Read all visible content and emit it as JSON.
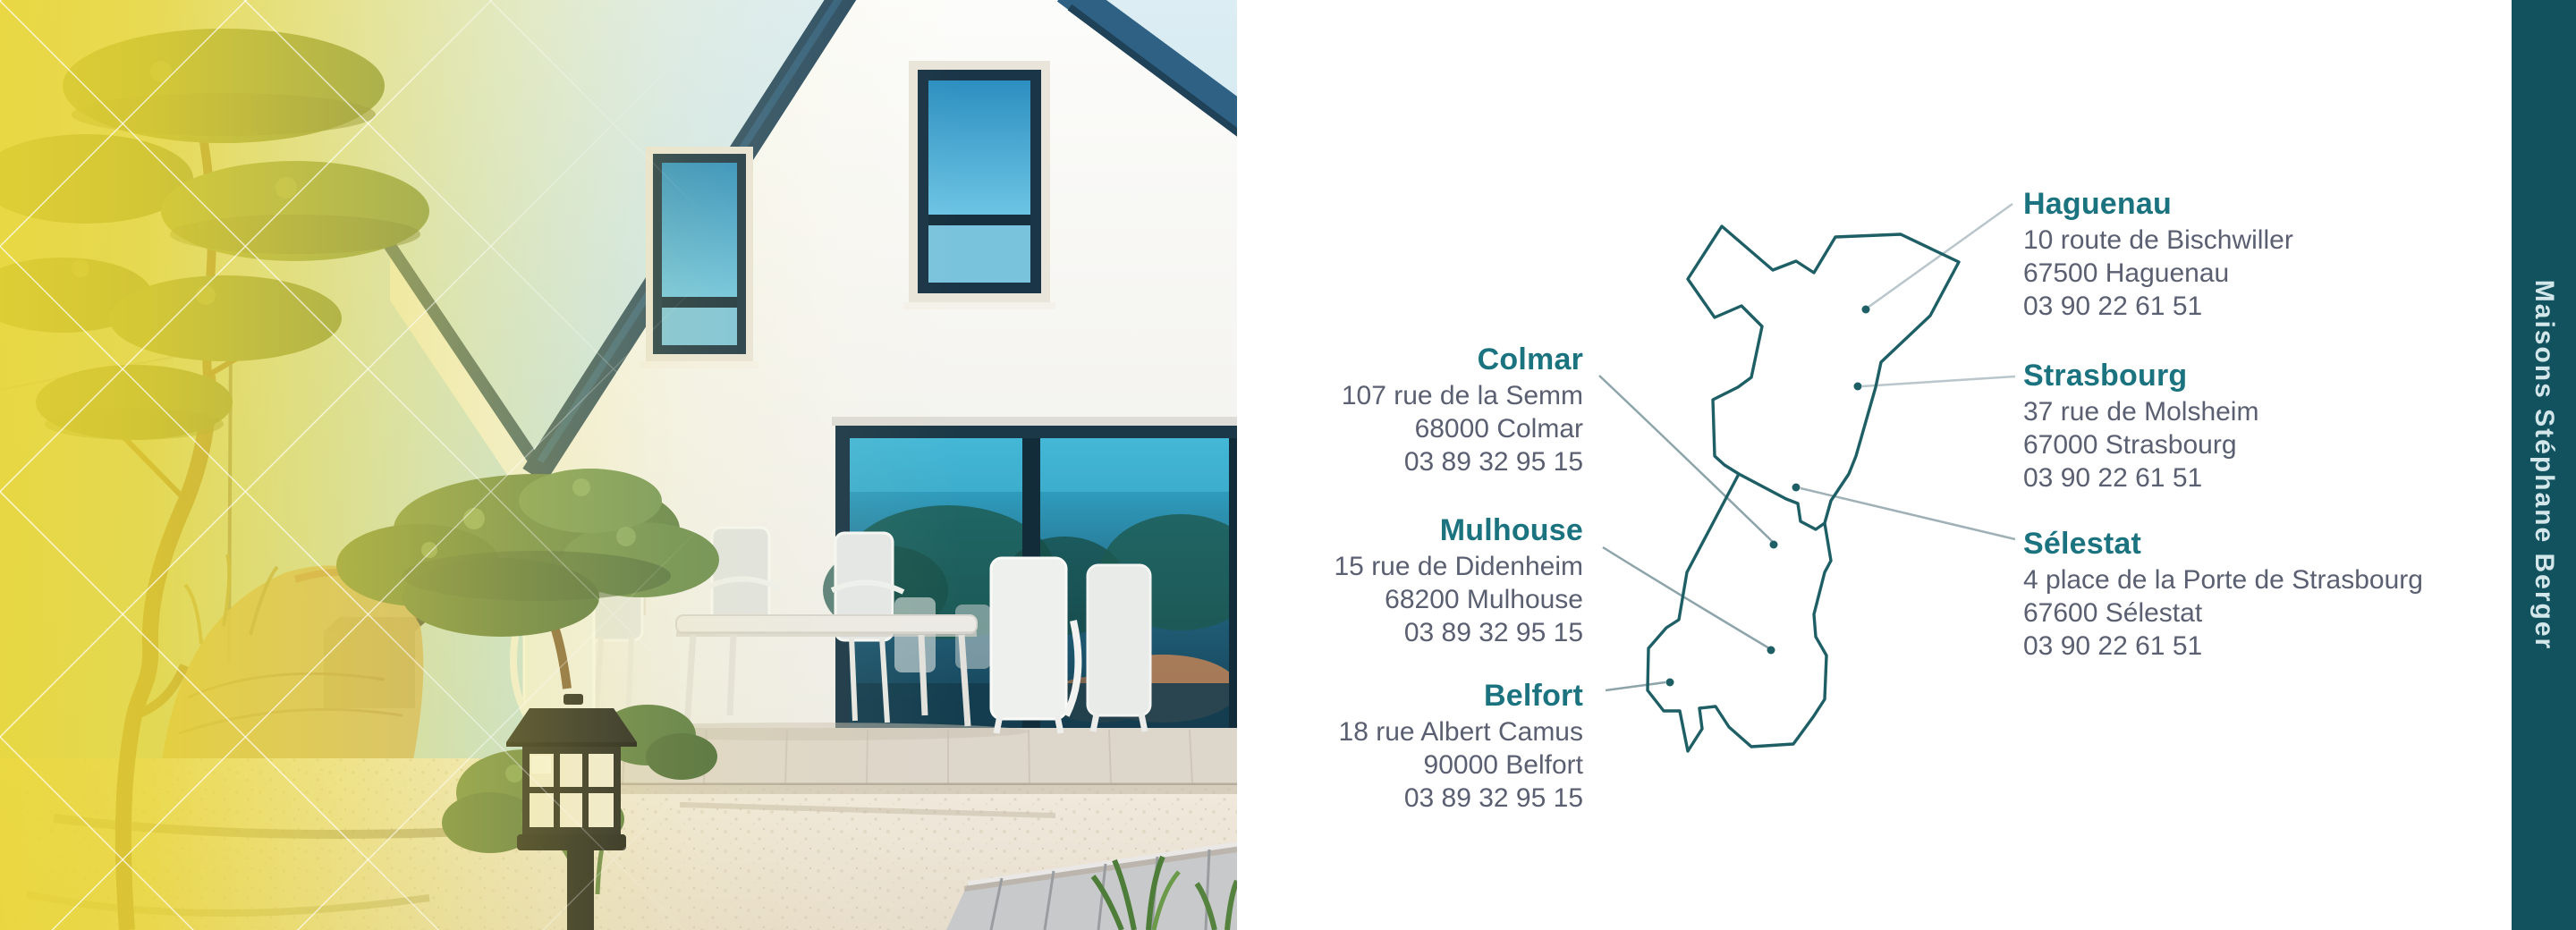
{
  "brand": {
    "name": "Maisons Stéphane Berger"
  },
  "colors": {
    "accent_teal": "#1b7380",
    "address_gray": "#5a5f71",
    "map_outline": "#1e5f66",
    "sidebar_bg": "#12525f",
    "overlay_yellow": "#e9d536"
  },
  "offices": [
    {
      "city": "Haguenau",
      "address": "10 route de Bischwiller",
      "postal_city": "67500 Haguenau",
      "phone": "03 90 22 61 51"
    },
    {
      "city": "Strasbourg",
      "address": "37 rue de Molsheim",
      "postal_city": "67000 Strasbourg",
      "phone": "03 90 22 61 51"
    },
    {
      "city": "Sélestat",
      "address": "4 place de la Porte de Strasbourg",
      "postal_city": "67600 Sélestat",
      "phone": "03 90 22 61 51"
    },
    {
      "city": "Colmar",
      "address": "107 rue de la Semm",
      "postal_city": "68000 Colmar",
      "phone": "03 89 32 95 15"
    },
    {
      "city": "Mulhouse",
      "address": "15 rue de Didenheim",
      "postal_city": "68200 Mulhouse",
      "phone": "03 89 32 95 15"
    },
    {
      "city": "Belfort",
      "address": "18 rue Albert Camus",
      "postal_city": "90000 Belfort",
      "phone": "03 89 32 95 15"
    }
  ]
}
